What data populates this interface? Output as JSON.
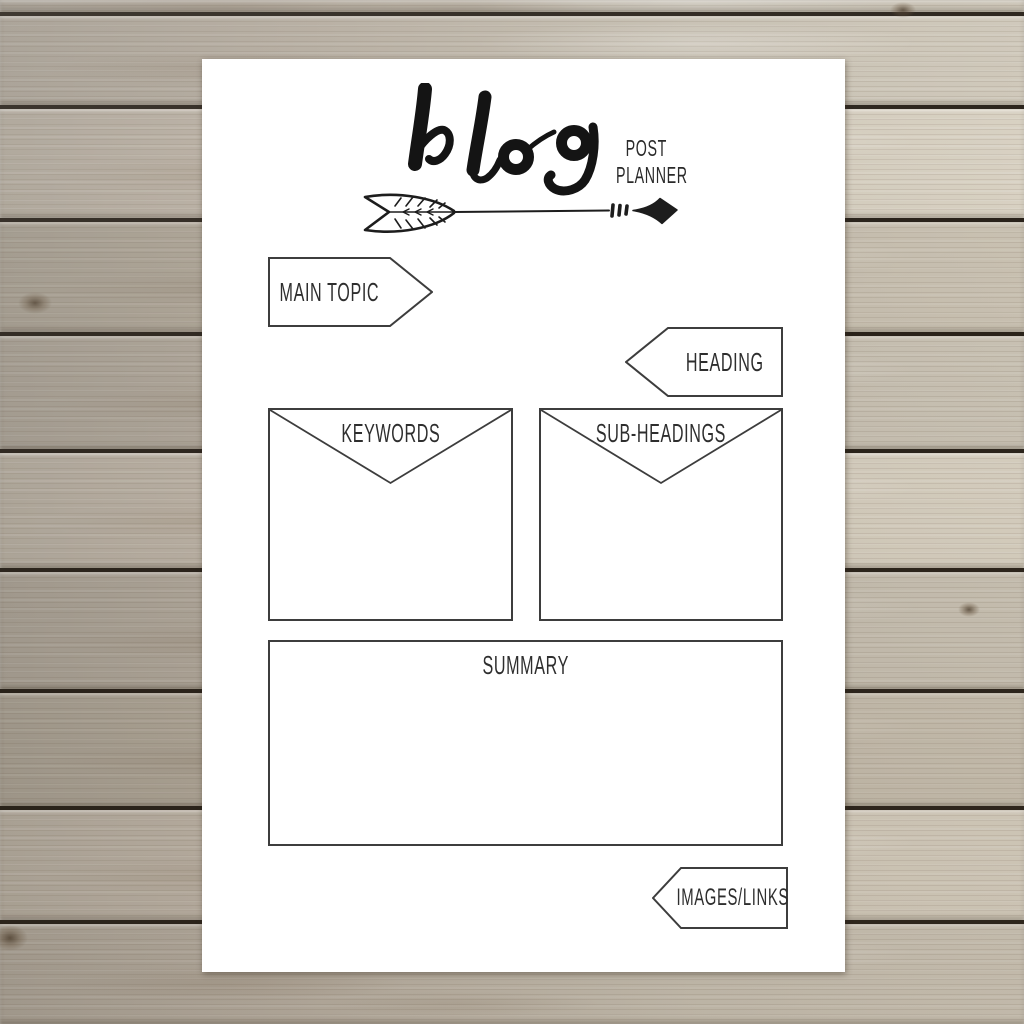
{
  "header": {
    "script_word": "blog",
    "subtitle_line1": "POST",
    "subtitle_line2": "PLANNER"
  },
  "decorations": {
    "arrow": "hand-drawn-arrow-right"
  },
  "fields": {
    "main_topic": {
      "label": "MAIN TOPIC"
    },
    "heading": {
      "label": "HEADING"
    },
    "keywords": {
      "label": "KEYWORDS"
    },
    "sub_headings": {
      "label": "SUB-HEADINGS"
    },
    "summary": {
      "label": "SUMMARY"
    },
    "images_links": {
      "label": "IMAGES/LINKS"
    }
  },
  "colors": {
    "ink": "#2e2e2e",
    "title_ink": "#141414",
    "paper": "#ffffff",
    "wood_base": "#b3aa9d",
    "wood_gap": "#29221a"
  }
}
